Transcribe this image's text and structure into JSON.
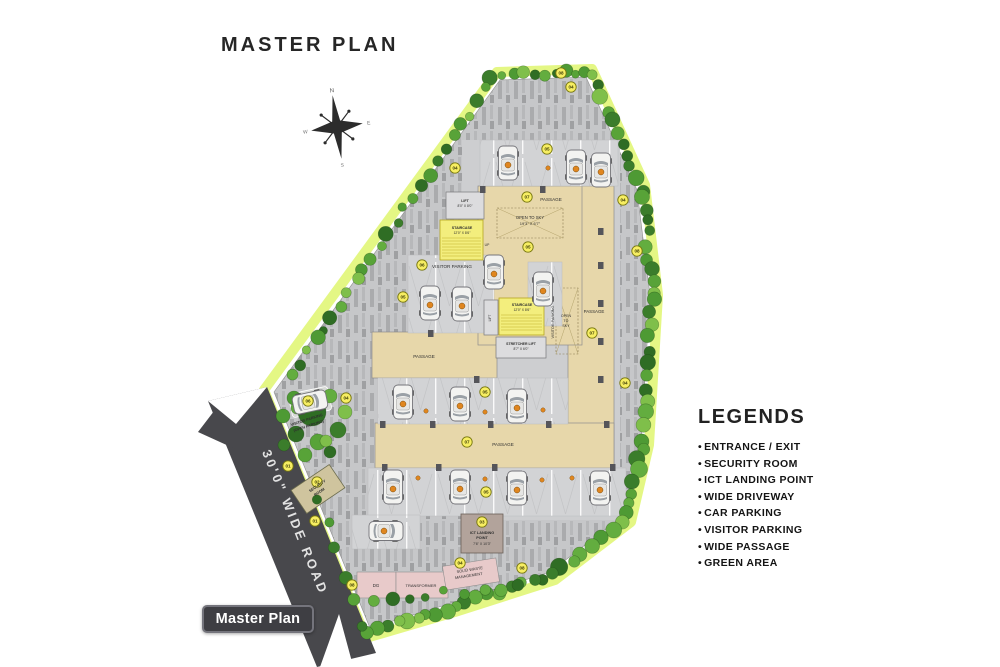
{
  "title": "MASTER  PLAN",
  "badge": "Master Plan",
  "legend": {
    "heading": "LEGENDS",
    "bullet": "•",
    "items": [
      "ENTRANCE / EXIT",
      "SECURITY ROOM",
      "ICT LANDING POINT",
      "WIDE DRIVEWAY",
      "CAR PARKING",
      "VISITOR PARKING",
      "WIDE PASSAGE",
      "GREEN AREA"
    ]
  },
  "compass": {
    "n": "N",
    "e": "E",
    "s": "S",
    "w": "W"
  },
  "colors": {
    "road": "#48484c",
    "paving_hatch": "#c6c7c9",
    "passage_tan": "#e7d7aa",
    "stair_yellow": "#f3ee7d",
    "marker_yellow": "#f7ee62",
    "utility_pink": "#e8caca",
    "green_glow": "#e3f77d",
    "tree_green": "#4e9a34",
    "car_chip_orange": "#e0861f"
  },
  "plan": {
    "markers": [
      {
        "n": "01",
        "x": 288,
        "y": 466
      },
      {
        "n": "01",
        "x": 315,
        "y": 521
      },
      {
        "n": "02",
        "x": 317,
        "y": 482
      },
      {
        "n": "03",
        "x": 482,
        "y": 522
      },
      {
        "n": "04",
        "x": 571,
        "y": 87
      },
      {
        "n": "04",
        "x": 455,
        "y": 168
      },
      {
        "n": "04",
        "x": 623,
        "y": 200
      },
      {
        "n": "04",
        "x": 625,
        "y": 383
      },
      {
        "n": "04",
        "x": 346,
        "y": 398
      },
      {
        "n": "04",
        "x": 460,
        "y": 563
      },
      {
        "n": "05",
        "x": 547,
        "y": 149
      },
      {
        "n": "05",
        "x": 528,
        "y": 247
      },
      {
        "n": "05",
        "x": 403,
        "y": 297
      },
      {
        "n": "05",
        "x": 485,
        "y": 392
      },
      {
        "n": "05",
        "x": 486,
        "y": 492
      },
      {
        "n": "06",
        "x": 422,
        "y": 265
      },
      {
        "n": "06",
        "x": 308,
        "y": 401
      },
      {
        "n": "07",
        "x": 527,
        "y": 197
      },
      {
        "n": "07",
        "x": 592,
        "y": 333
      },
      {
        "n": "07",
        "x": 467,
        "y": 442
      },
      {
        "n": "08",
        "x": 561,
        "y": 73
      },
      {
        "n": "08",
        "x": 637,
        "y": 251
      },
      {
        "n": "08",
        "x": 522,
        "y": 568
      },
      {
        "n": "08",
        "x": 352,
        "y": 585
      }
    ],
    "labels": [
      {
        "t": "PASSAGE",
        "x": 551,
        "y": 201,
        "s": 4.6
      },
      {
        "t": "OPEN TO SKY",
        "x": 530,
        "y": 219,
        "s": 4.2
      },
      {
        "t": "19'3\" X 6'7\"",
        "x": 530,
        "y": 225,
        "s": 4.0
      },
      {
        "t": "VISITOR PARKING",
        "x": 452,
        "y": 268,
        "s": 4.6
      },
      {
        "t": "PASSAGE",
        "x": 424,
        "y": 358,
        "s": 4.6
      },
      {
        "t": "PASSAGE",
        "x": 503,
        "y": 446,
        "s": 4.6
      },
      {
        "t": "PASSAGE",
        "x": 594,
        "y": 313,
        "s": 4.4
      },
      {
        "t": "VISITOR PARKING",
        "x": 554,
        "y": 322,
        "s": 3.8,
        "r": -90
      },
      {
        "t": "OPEN",
        "x": 566,
        "y": 317,
        "s": 3.6
      },
      {
        "t": "TO",
        "x": 566,
        "y": 322,
        "s": 3.6
      },
      {
        "t": "SKY",
        "x": 566,
        "y": 327,
        "s": 3.6
      },
      {
        "t": "LIFT",
        "x": 465,
        "y": 202,
        "s": 3.6,
        "w": 700
      },
      {
        "t": "8'0\" X 8'0\"",
        "x": 465,
        "y": 207,
        "s": 3.3
      },
      {
        "t": "STAIRCASE",
        "x": 462,
        "y": 229,
        "s": 3.6,
        "w": 700
      },
      {
        "t": "12'0\" X 8'6\"",
        "x": 462,
        "y": 234,
        "s": 3.3
      },
      {
        "t": "UP",
        "x": 487,
        "y": 246,
        "s": 3.4
      },
      {
        "t": "STAIRCASE",
        "x": 522,
        "y": 306,
        "s": 3.6,
        "w": 700
      },
      {
        "t": "12'0\" X 8'6\"",
        "x": 522,
        "y": 311,
        "s": 3.3
      },
      {
        "t": "LIFT",
        "x": 491,
        "y": 318,
        "s": 3.3,
        "r": -90
      },
      {
        "t": "STRETCHER LIFT",
        "x": 521,
        "y": 345,
        "s": 3.5,
        "w": 700
      },
      {
        "t": "8'7\" X 6'0\"",
        "x": 521,
        "y": 350,
        "s": 3.3
      },
      {
        "t": "ICT LANDING",
        "x": 482,
        "y": 534,
        "s": 3.8,
        "w": 700
      },
      {
        "t": "POINT",
        "x": 482,
        "y": 539,
        "s": 3.8,
        "w": 700
      },
      {
        "t": "7'6\" X 10'3\"",
        "x": 482,
        "y": 545,
        "s": 3.5
      },
      {
        "t": "SECURITY",
        "x": 318,
        "y": 487,
        "s": 3.8,
        "r": -34,
        "w": 700
      },
      {
        "t": "ROOM",
        "x": 320,
        "y": 493,
        "s": 3.8,
        "r": -34,
        "w": 700
      },
      {
        "t": "VISITOR PARKING",
        "x": 307,
        "y": 421,
        "s": 3.8,
        "r": -18,
        "w": 700
      },
      {
        "t": "(OPEN PARKING)",
        "x": 309,
        "y": 427,
        "s": 3.8,
        "r": -18,
        "w": 700
      },
      {
        "t": "DG",
        "x": 376,
        "y": 587,
        "s": 4.4
      },
      {
        "t": "TRANSFORMER",
        "x": 421,
        "y": 587,
        "s": 4.0
      },
      {
        "t": "SOLID WASTE",
        "x": 470,
        "y": 571,
        "s": 3.9,
        "r": -9
      },
      {
        "t": "MANAGEMENT",
        "x": 469,
        "y": 577,
        "s": 3.9,
        "r": -9
      },
      {
        "t": "30'0\"  WIDE  ROAD",
        "x": 291,
        "y": 524,
        "s": 13,
        "r": 68,
        "fill": "#e3e3e3",
        "ls": 3,
        "w": 600
      }
    ],
    "cars": [
      {
        "x": 508,
        "y": 163,
        "r": 0
      },
      {
        "x": 576,
        "y": 167,
        "r": 0
      },
      {
        "x": 601,
        "y": 170,
        "r": 0
      },
      {
        "x": 494,
        "y": 272,
        "r": 0
      },
      {
        "x": 543,
        "y": 289,
        "r": 0
      },
      {
        "x": 430,
        "y": 303,
        "r": 0
      },
      {
        "x": 462,
        "y": 304,
        "r": 0
      },
      {
        "x": 403,
        "y": 402,
        "r": 0
      },
      {
        "x": 460,
        "y": 404,
        "r": 0
      },
      {
        "x": 517,
        "y": 406,
        "r": 0
      },
      {
        "x": 393,
        "y": 487,
        "r": 0
      },
      {
        "x": 460,
        "y": 487,
        "r": 0
      },
      {
        "x": 517,
        "y": 488,
        "r": 0
      },
      {
        "x": 600,
        "y": 488,
        "r": 0
      },
      {
        "x": 386,
        "y": 531,
        "r": 90
      },
      {
        "x": 310,
        "y": 402,
        "r": 78
      }
    ],
    "stall_chips": [
      [
        548,
        168
      ],
      [
        426,
        411
      ],
      [
        485,
        412
      ],
      [
        543,
        410
      ],
      [
        418,
        478
      ],
      [
        485,
        479
      ],
      [
        542,
        480
      ],
      [
        572,
        478
      ]
    ]
  }
}
